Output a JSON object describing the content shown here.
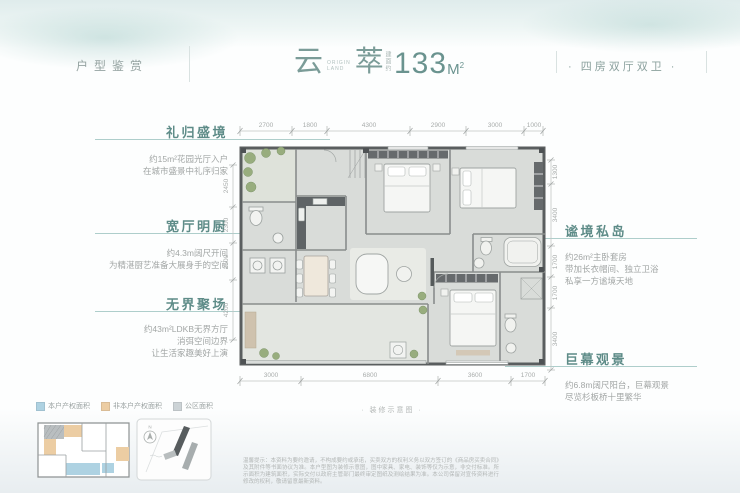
{
  "header": {
    "left_label": "户型鉴赏",
    "title_char1": "云",
    "title_char2": "萃",
    "title_sub1": "ORIGIN",
    "title_sub2": "LAND",
    "area_prefix": "建面约",
    "area_value": "133",
    "area_unit": "M",
    "area_sup": "2",
    "right_label": "· 四房双厅双卫 ·"
  },
  "callouts_left": [
    {
      "title": "礼归盛境",
      "line1": "约15m²花园光厅入户",
      "line2": "在城市盛景中礼序归家"
    },
    {
      "title": "宽厅明厨",
      "line1": "约4.3m阔尺开间",
      "line2": "为精湛厨艺准备大展身手的空间"
    },
    {
      "title": "无界聚场",
      "line1": "约43m²LDKB无界方厅",
      "line2": "消弭空间边界",
      "line3": "让生活家趣美好上演"
    }
  ],
  "callouts_right": [
    {
      "title": "谧境私岛",
      "line1": "约26m²主卧套房",
      "line2": "带加长衣帽间、独立卫浴",
      "line3": "私享一方谧境天地"
    },
    {
      "title": "巨幕观景",
      "line1": "约6.8m阔尺阳台，巨幕观景",
      "line2": "尽览杉板桥十里繁华"
    }
  ],
  "dimensions": {
    "top": [
      "2700",
      "1800",
      "4300",
      "2900",
      "3000",
      "1000"
    ],
    "bottom": [
      "3000",
      "6800",
      "3600",
      "1700"
    ],
    "left": [
      "2450",
      "2300",
      "2500",
      "4200"
    ],
    "right": [
      "1300",
      "3400",
      "1700",
      "1700",
      "3400"
    ]
  },
  "plan_note": "· 装修示意图 ·",
  "legend": {
    "items": [
      {
        "label": "本户产权面积",
        "color": "#aed2e2",
        "swatch_style": "background:#aed2e2"
      },
      {
        "label": "非本户产权面积",
        "color": "#eccda3",
        "swatch_style": "background:#eccda3"
      },
      {
        "label": "公区面积",
        "color": "#ccd3d6",
        "swatch_style": "background:#ccd3d6"
      }
    ]
  },
  "site_thumb": {
    "compass": "N"
  },
  "colors": {
    "accent_teal": "#5e8c88",
    "title_teal": "#7b9c98"
  },
  "disclaimer": "温馨提示：本资料为要约邀请，不构成要约或承诺，买卖双方的权利义务以双方签订的《商品房买卖合同》及其附件等书面协议为准。本户型图为装修示意图，图中家具、家电、装饰等仅为示意，非交付标准。所示面积为建筑面积，实际交付以政府主管部门最终审定图纸及测绘结果为准。本公司保留对宣传资料进行修改的权利，敬请留意最新资料。"
}
